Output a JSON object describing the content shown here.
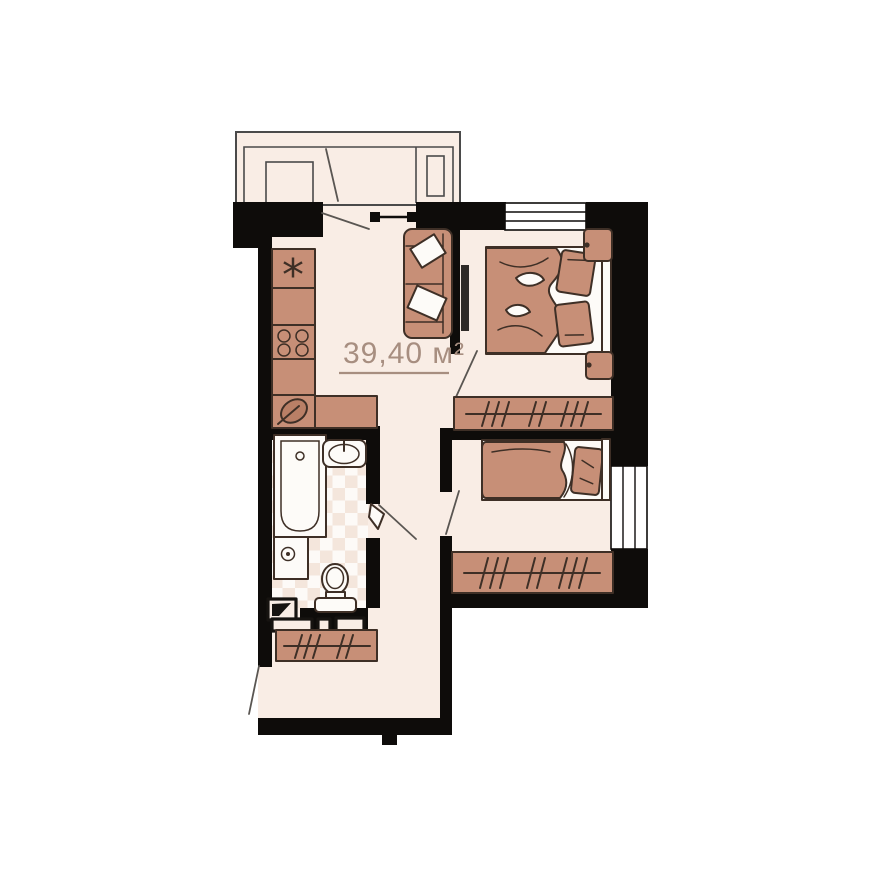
{
  "floor_plan": {
    "area_label": "39,40 м²",
    "kitchen_unit_symbol": "*",
    "colors": {
      "wall": "#0e0c0a",
      "floor": "#f9ede5",
      "tile_light": "#fdfaf7",
      "tile_dark": "#f4e6dc",
      "furniture": "#c78f77",
      "furniture_shade": "#b97f66",
      "outline": "#3e2f26",
      "fixture": "#fdfbf8",
      "label": "#a78e80",
      "railing": "#4a4a4a",
      "swing": "#5a5652",
      "tv": "#2f2a27"
    }
  }
}
